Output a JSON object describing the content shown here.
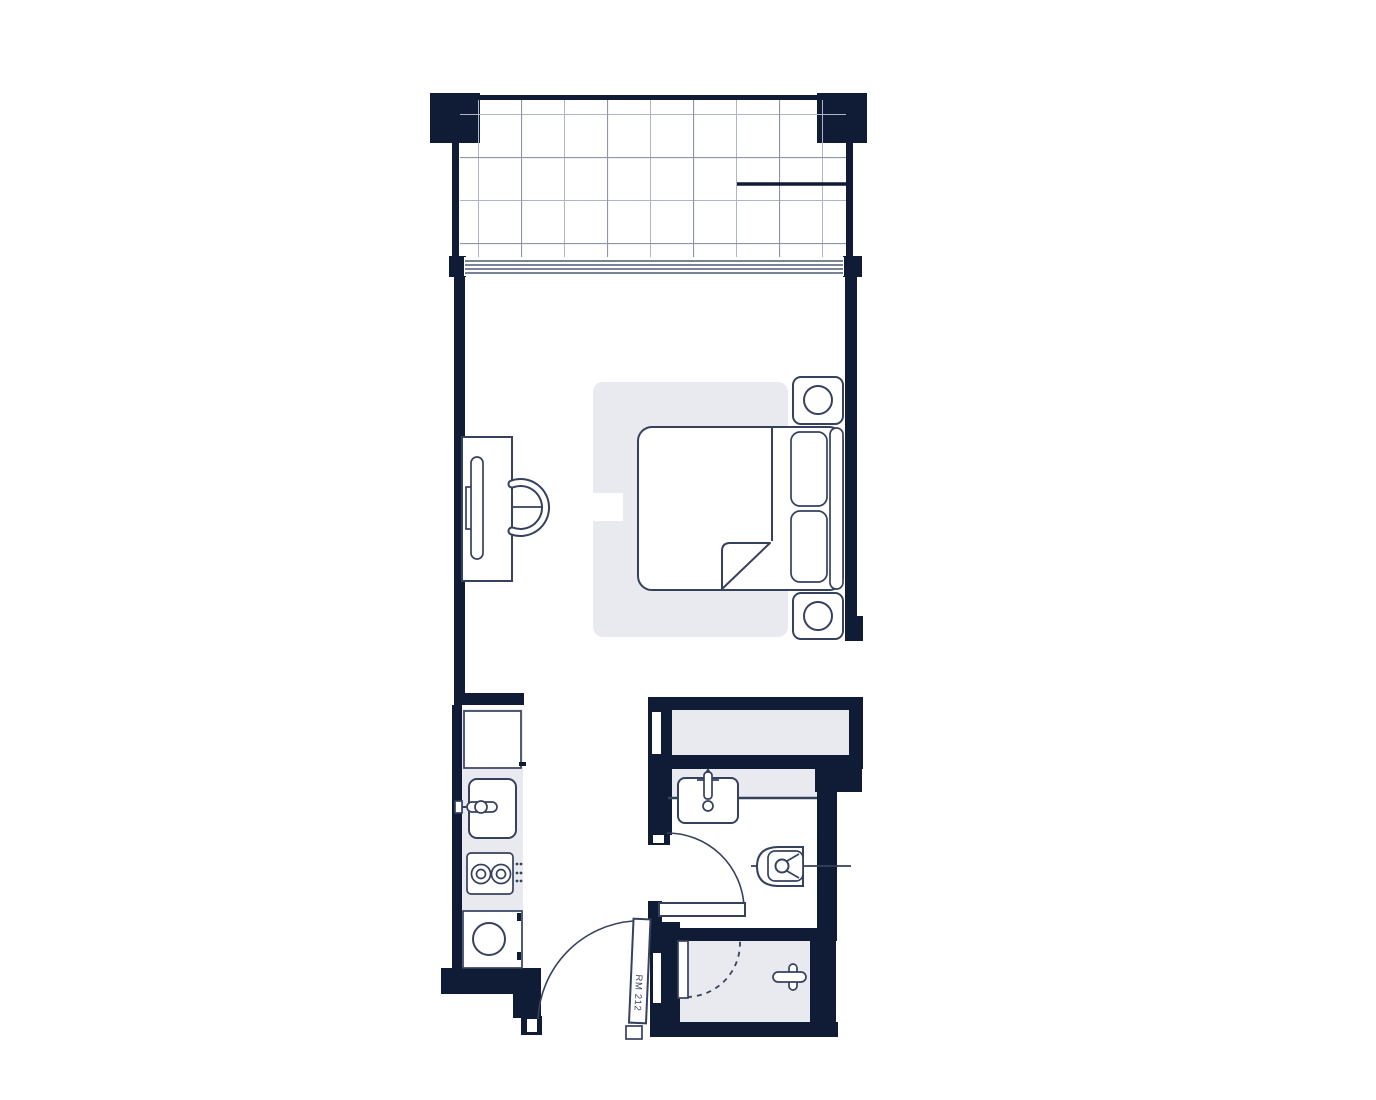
{
  "door": {
    "label": "RM 212"
  },
  "theme": {
    "wall": "#101c36",
    "outline": "#36415e",
    "outline-strong": "#273352",
    "fill": "#e8eaef",
    "grid": "#aeb6c6",
    "grid-strong": "#8b95ab",
    "paper": "#ffffff"
  },
  "fixtures": {
    "balcony": [
      "tile-grid",
      "privacy-divider",
      "sliding-glass-door"
    ],
    "living": [
      "area-rug",
      "double-bed",
      "folded-blanket",
      "pillow",
      "headboard",
      "nightstand",
      "table-lamp",
      "desk",
      "desk-chair"
    ],
    "kitchen": [
      "refrigerator",
      "kitchen-sink",
      "faucet",
      "two-burner-cooktop",
      "washer"
    ],
    "bathroom": [
      "wardrobe-closet",
      "vanity-counter",
      "bathroom-sink",
      "wall-hung-toilet",
      "hinged-door"
    ],
    "shower_room": [
      "shower-floor",
      "shower-door",
      "shower-rail"
    ],
    "entry": [
      "entry-door",
      "door-swing-arc",
      "door-stop"
    ]
  }
}
